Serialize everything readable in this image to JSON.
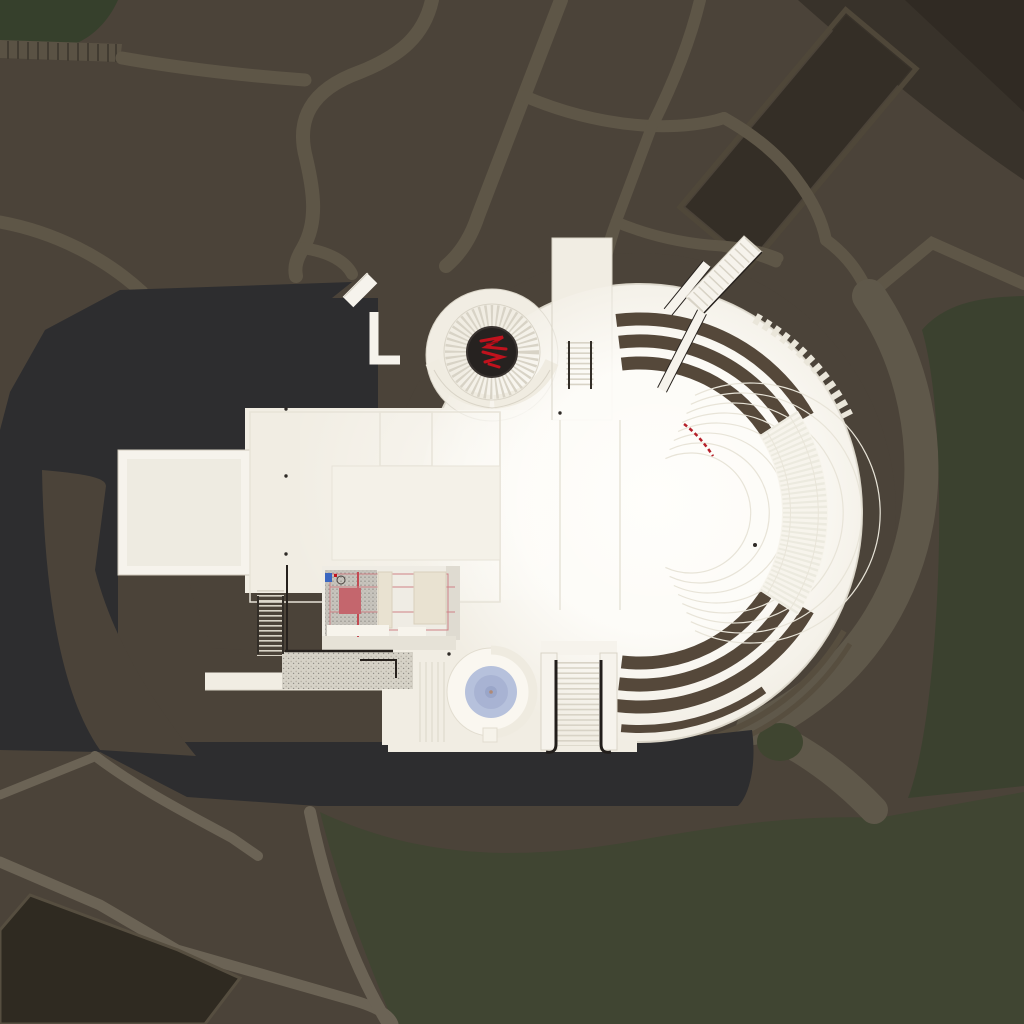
{
  "scene": {
    "kind": "aerial-architectural-site-render",
    "view": "top-down"
  },
  "colors": {
    "terrain": "#4b4339",
    "terrainLight": "#534b3f",
    "path": "#5e5647",
    "pathLight": "#6b6355",
    "ribbed": "#5a5244",
    "ribLine": "#423c32",
    "greenTL": "#36402c",
    "greenR": "#3b412f",
    "greenB": "#404532",
    "oliveTree": "#3f4530",
    "wedge": "#38322a",
    "wedgeDark": "#302a23",
    "courtyard": "#342e26",
    "courtyardRim": "#4f4739",
    "garden": "#2f2a21",
    "gardenRim": "#564e40",
    "shadow": "#2d2d2f",
    "road": "#5f584a",
    "white": "#f1ede3",
    "whiteWall": "#f6f3ec",
    "whiteBright": "#fffefb",
    "wingFloor": "#eeebe1",
    "outline": "#d9d4c7",
    "faintLine": "#e7e3d8",
    "brightPanel": "#f4f1e8",
    "bandBrown": "#55483a",
    "rimStep": "#574e3f",
    "dentil": "#eae6da",
    "ringLine": "#e8e4d8",
    "texBand": "#f7f4ec",
    "texTick": "#eceadf",
    "stepLine": "#d8d3c6",
    "darkLine": "#26211d",
    "railDark": "#332e28",
    "red": "#c1121d",
    "redDark": "#8f0d15",
    "redLine": "#cf8286",
    "redArc": "#b5202a",
    "carpet": "#c4666d",
    "panel": "#e9e2d1",
    "panelLine": "#d9d0bd",
    "roomGray": "#c7c4bd",
    "speckDot": "#908d86",
    "terrGray": "#d6d2c7",
    "terrDot": "#b9b4a8",
    "apron": "#e6e2d7",
    "grayFloor": "#dfdbd1",
    "blueOuter": "#b6c1dc",
    "blueInner": "#a8b3d3",
    "blueCore": "#9aa6c9",
    "blueMark": "#3a66c0",
    "apseDisc": "#262220",
    "dotMark": "#2e2a26"
  }
}
